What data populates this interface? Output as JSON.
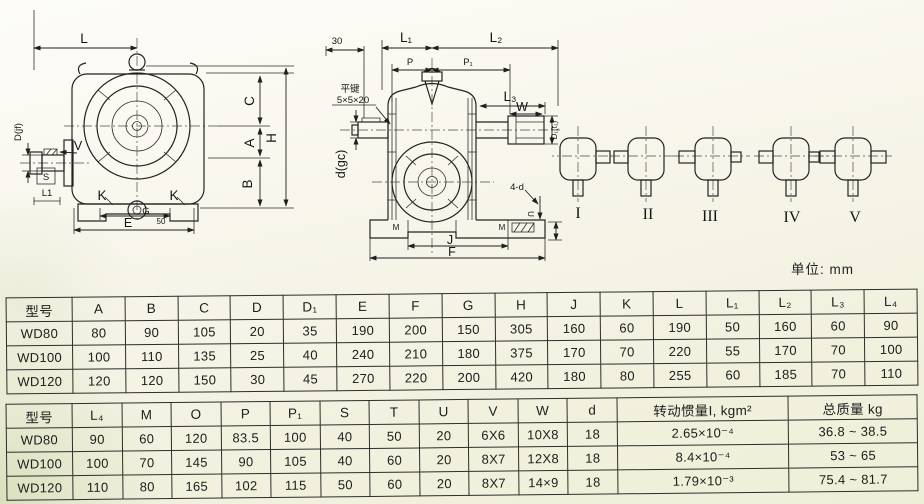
{
  "page": {
    "unit_label": "单位: mm"
  },
  "front_view": {
    "L": "L",
    "C": "C",
    "A": "A",
    "H": "H",
    "B": "B",
    "D_jf": "D(jf)",
    "V": "V",
    "S": "S",
    "L1": "L1",
    "K_left": "K",
    "K_right": "K",
    "G": "G",
    "n50": "50",
    "E": "E"
  },
  "side_view": {
    "n30": "30",
    "L1": "L₁",
    "L2": "L₂",
    "P": "P",
    "P1": "P₁",
    "L3": "L₃",
    "W": "W",
    "D1": "D₁(t₁)",
    "key_note_1": "平键",
    "key_note_2": "5×5×20",
    "d_gc": "d(gc)",
    "four_d": "4-d",
    "U": "U",
    "M_left": "M",
    "M_right": "M",
    "J": "J",
    "F": "F"
  },
  "variants": {
    "labels": [
      "I",
      "II",
      "III",
      "IV",
      "V"
    ]
  },
  "tables": [
    {
      "headers": [
        "型号",
        "A",
        "B",
        "C",
        "D",
        "D₁",
        "E",
        "F",
        "G",
        "H",
        "J",
        "K",
        "L",
        "L₁",
        "L₂",
        "L₃",
        "L₄"
      ],
      "rows": [
        [
          "WD80",
          "80",
          "90",
          "105",
          "20",
          "35",
          "190",
          "200",
          "150",
          "305",
          "160",
          "60",
          "190",
          "50",
          "160",
          "60",
          "90"
        ],
        [
          "WD100",
          "100",
          "110",
          "135",
          "25",
          "40",
          "240",
          "210",
          "180",
          "375",
          "170",
          "70",
          "220",
          "55",
          "170",
          "70",
          "100"
        ],
        [
          "WD120",
          "120",
          "120",
          "150",
          "30",
          "45",
          "270",
          "220",
          "200",
          "420",
          "180",
          "80",
          "255",
          "60",
          "185",
          "70",
          "110"
        ]
      ]
    },
    {
      "headers": [
        "型号",
        "L₄",
        "M",
        "O",
        "P",
        "P₁",
        "S",
        "T",
        "U",
        "V",
        "W",
        "d",
        "转动惯量I, kgm²",
        "总质量 kg"
      ],
      "rows": [
        [
          "WD80",
          "90",
          "60",
          "120",
          "83.5",
          "100",
          "40",
          "50",
          "20",
          "6X6",
          "10X8",
          "18",
          "2.65×10⁻⁴",
          "36.8 ~ 38.5"
        ],
        [
          "WD100",
          "100",
          "70",
          "145",
          "90",
          "105",
          "40",
          "60",
          "20",
          "8X7",
          "12X8",
          "18",
          "8.4×10⁻⁴",
          "53 ~ 65"
        ],
        [
          "WD120",
          "110",
          "80",
          "165",
          "102",
          "115",
          "50",
          "60",
          "20",
          "8X7",
          "14×9",
          "18",
          "1.79×10⁻³",
          "75.4 ~ 81.7"
        ]
      ]
    }
  ]
}
